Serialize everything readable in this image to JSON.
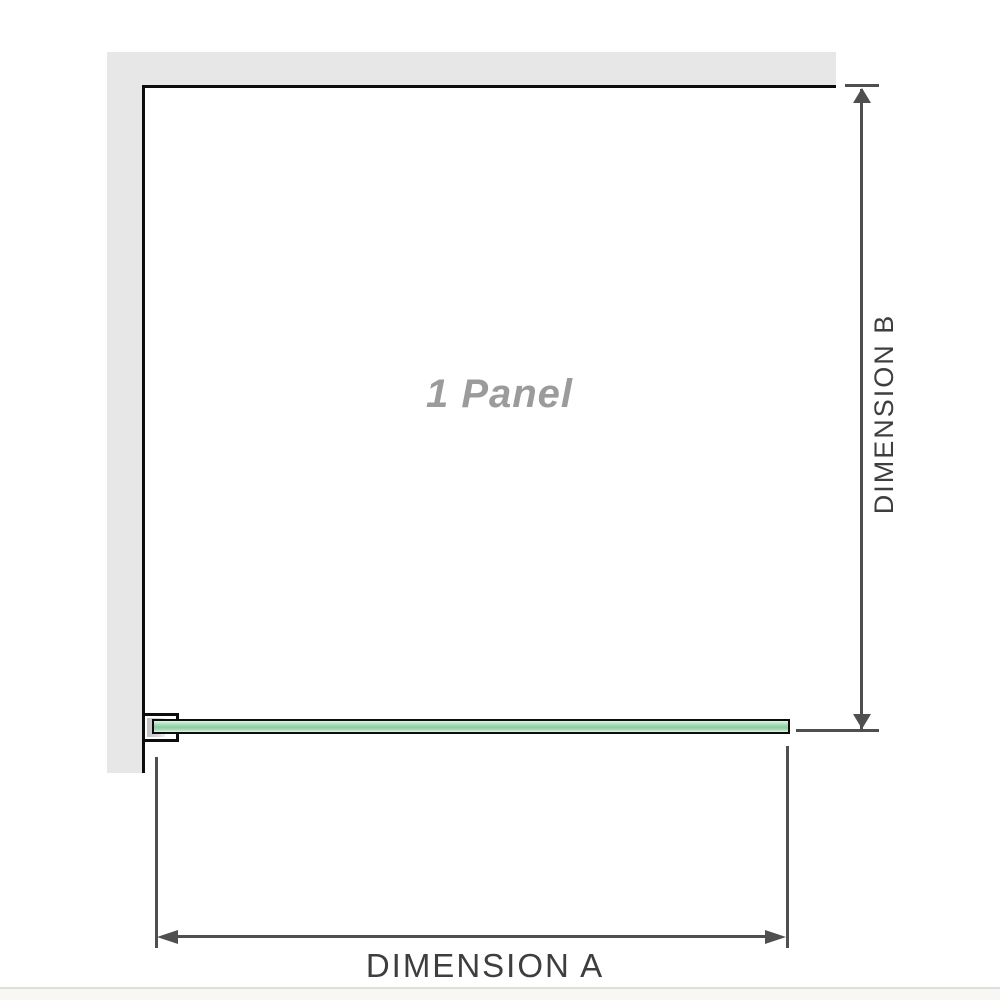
{
  "diagram": {
    "panel_label": "1 Panel",
    "dimension_a_label": "DIMENSION A",
    "dimension_b_label": "DIMENSION B",
    "colors": {
      "wall": "#e7e7e7",
      "outline": "#0d0d0d",
      "glass_light": "#e2f3e8",
      "glass_mid": "#a5dab7",
      "glass_dark": "#8bcd9f",
      "dimension_line": "#4f4f4f",
      "label_text": "#3e3e3e",
      "panel_text": "#9b9b9b"
    }
  }
}
